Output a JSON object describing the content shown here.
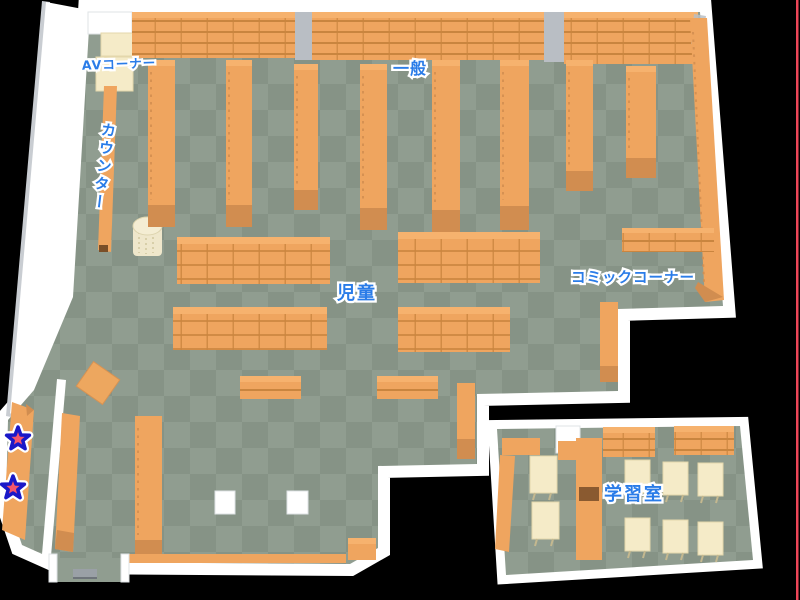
{
  "map": {
    "areas": [
      {
        "id": "av-corner",
        "label": "AVコーナー"
      },
      {
        "id": "counter",
        "label": "カウンター"
      },
      {
        "id": "general",
        "label": "一般"
      },
      {
        "id": "children",
        "label": "児童"
      },
      {
        "id": "comic-corner",
        "label": "コミックコーナー"
      },
      {
        "id": "study-room",
        "label": "学習室"
      }
    ],
    "markers": [
      {
        "id": "star-1",
        "icon": "star-marker-icon"
      },
      {
        "id": "star-2",
        "icon": "star-marker-icon"
      }
    ],
    "colors": {
      "background": "#000000",
      "wall": "#ffffff",
      "wall_shade": "#c9cdd2",
      "floor_light": "#909d90",
      "floor_dark": "#869386",
      "shelf": "#efa55f",
      "shelf_top": "#f6b26e",
      "shelf_dark": "#d18d50",
      "shelf_line": "#c9853f",
      "cream": "#f5ebc8",
      "cream_dark": "#e4d7ab",
      "pillar_gray": "#b9bec4",
      "label_blue": "#2a7ce8",
      "label_outline": "#ffffff",
      "star_fill": "#f4566c",
      "star_border": "#1a18c8",
      "edge_red": "#ee4658"
    }
  }
}
